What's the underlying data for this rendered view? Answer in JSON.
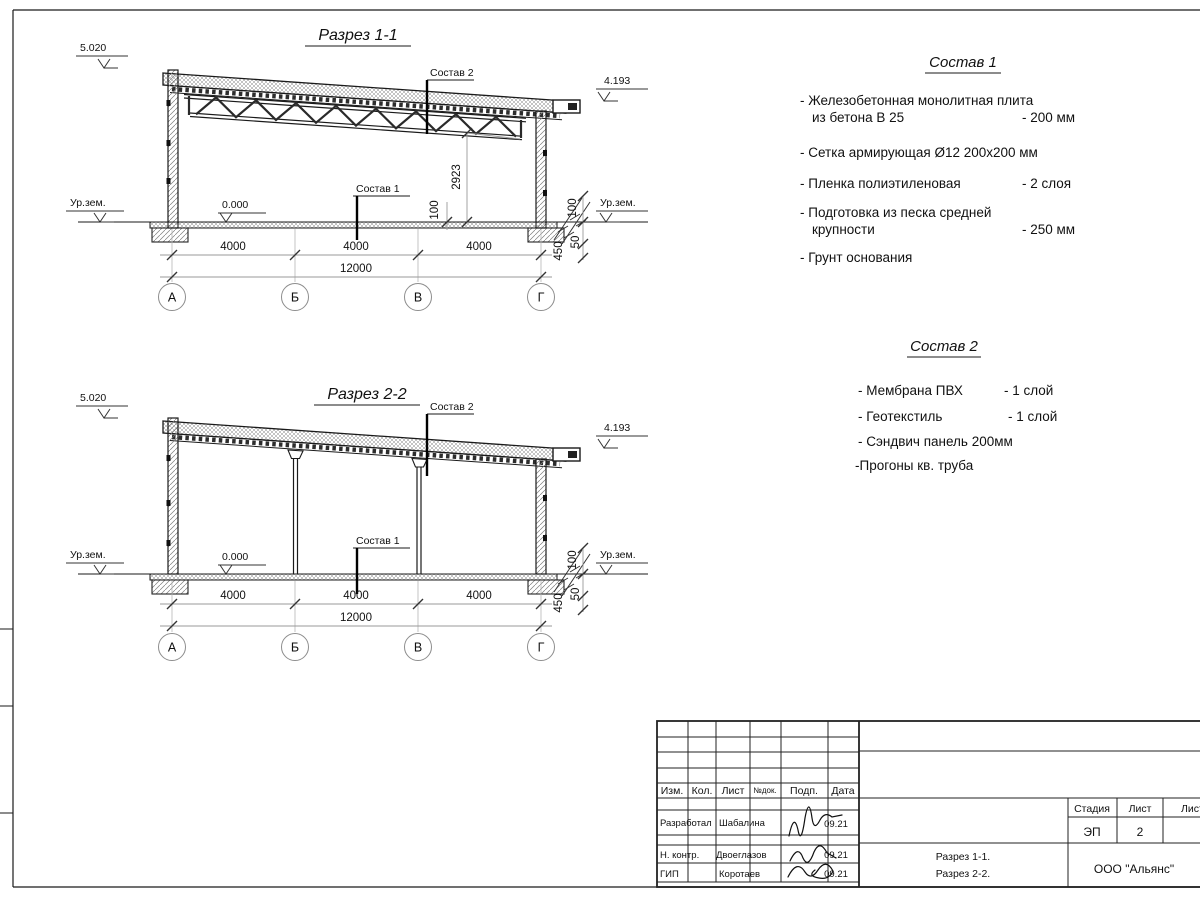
{
  "colors": {
    "ink": "#1a1a1a",
    "dim_line": "#999999",
    "hatch": "#8a8a8a",
    "paper": "#ffffff"
  },
  "sections": {
    "s1_title": "Разрез 1-1",
    "s2_title": "Разрез 2-2"
  },
  "labels": {
    "level_top": "5.020",
    "level_roof": "4.193",
    "level_zero": "0.000",
    "ground": "Ур.зем.",
    "sostav1": "Состав 1",
    "sostav2": "Состав 2"
  },
  "dims": {
    "span": "4000",
    "total": "12000",
    "height": "2923",
    "d100": "100",
    "d450": "450",
    "d50": "50"
  },
  "axes": [
    "А",
    "Б",
    "В",
    "Г"
  ],
  "compositions": [
    {
      "title": "Состав 1",
      "items": [
        {
          "line1": "- Железобетонная  монолитная плита",
          "line2": "из бетона В 25",
          "value": "- 200 мм"
        },
        {
          "line1": "- Сетка армирующая Ø12 200х200 мм",
          "line2": "",
          "value": ""
        },
        {
          "line1": "- Пленка полиэтиленовая",
          "line2": "",
          "value": "-  2 слоя"
        },
        {
          "line1": "- Подготовка из песка средней",
          "line2": "крупности",
          "value": "- 250 мм"
        },
        {
          "line1": "- Грунт основания",
          "line2": "",
          "value": ""
        }
      ]
    },
    {
      "title": "Состав 2",
      "items": [
        {
          "line1": "- Мембрана ПВХ",
          "value": "- 1 слой"
        },
        {
          "line1": "- Геотекстиль",
          "value": "- 1 слой"
        },
        {
          "line1": "- Сэндвич панель 200мм",
          "value": ""
        },
        {
          "line1": "-Прогоны кв. труба",
          "value": ""
        }
      ]
    }
  ],
  "titleblock": {
    "headers": {
      "izm": "Изм.",
      "kol": "Кол.",
      "list": "Лист",
      "ndok": "№док.",
      "podp": "Подп.",
      "data": "Дата",
      "stadia": "Стадия",
      "list2": "Лист",
      "listov": "Листов"
    },
    "stadia_value": "ЭП",
    "list_value": "2",
    "doc_line1": "Разрез 1-1.",
    "doc_line2": "Разрез 2-2.",
    "company": "ООО \"Альянс\"",
    "rows": [
      {
        "role": "Разработал",
        "name": "Шабалина",
        "date": "09.21"
      },
      {
        "role": "Н. контр.",
        "name": "Двоеглазов",
        "date": "09.21"
      },
      {
        "role": "ГИП",
        "name": "Коротаев",
        "date": "09.21"
      }
    ]
  }
}
